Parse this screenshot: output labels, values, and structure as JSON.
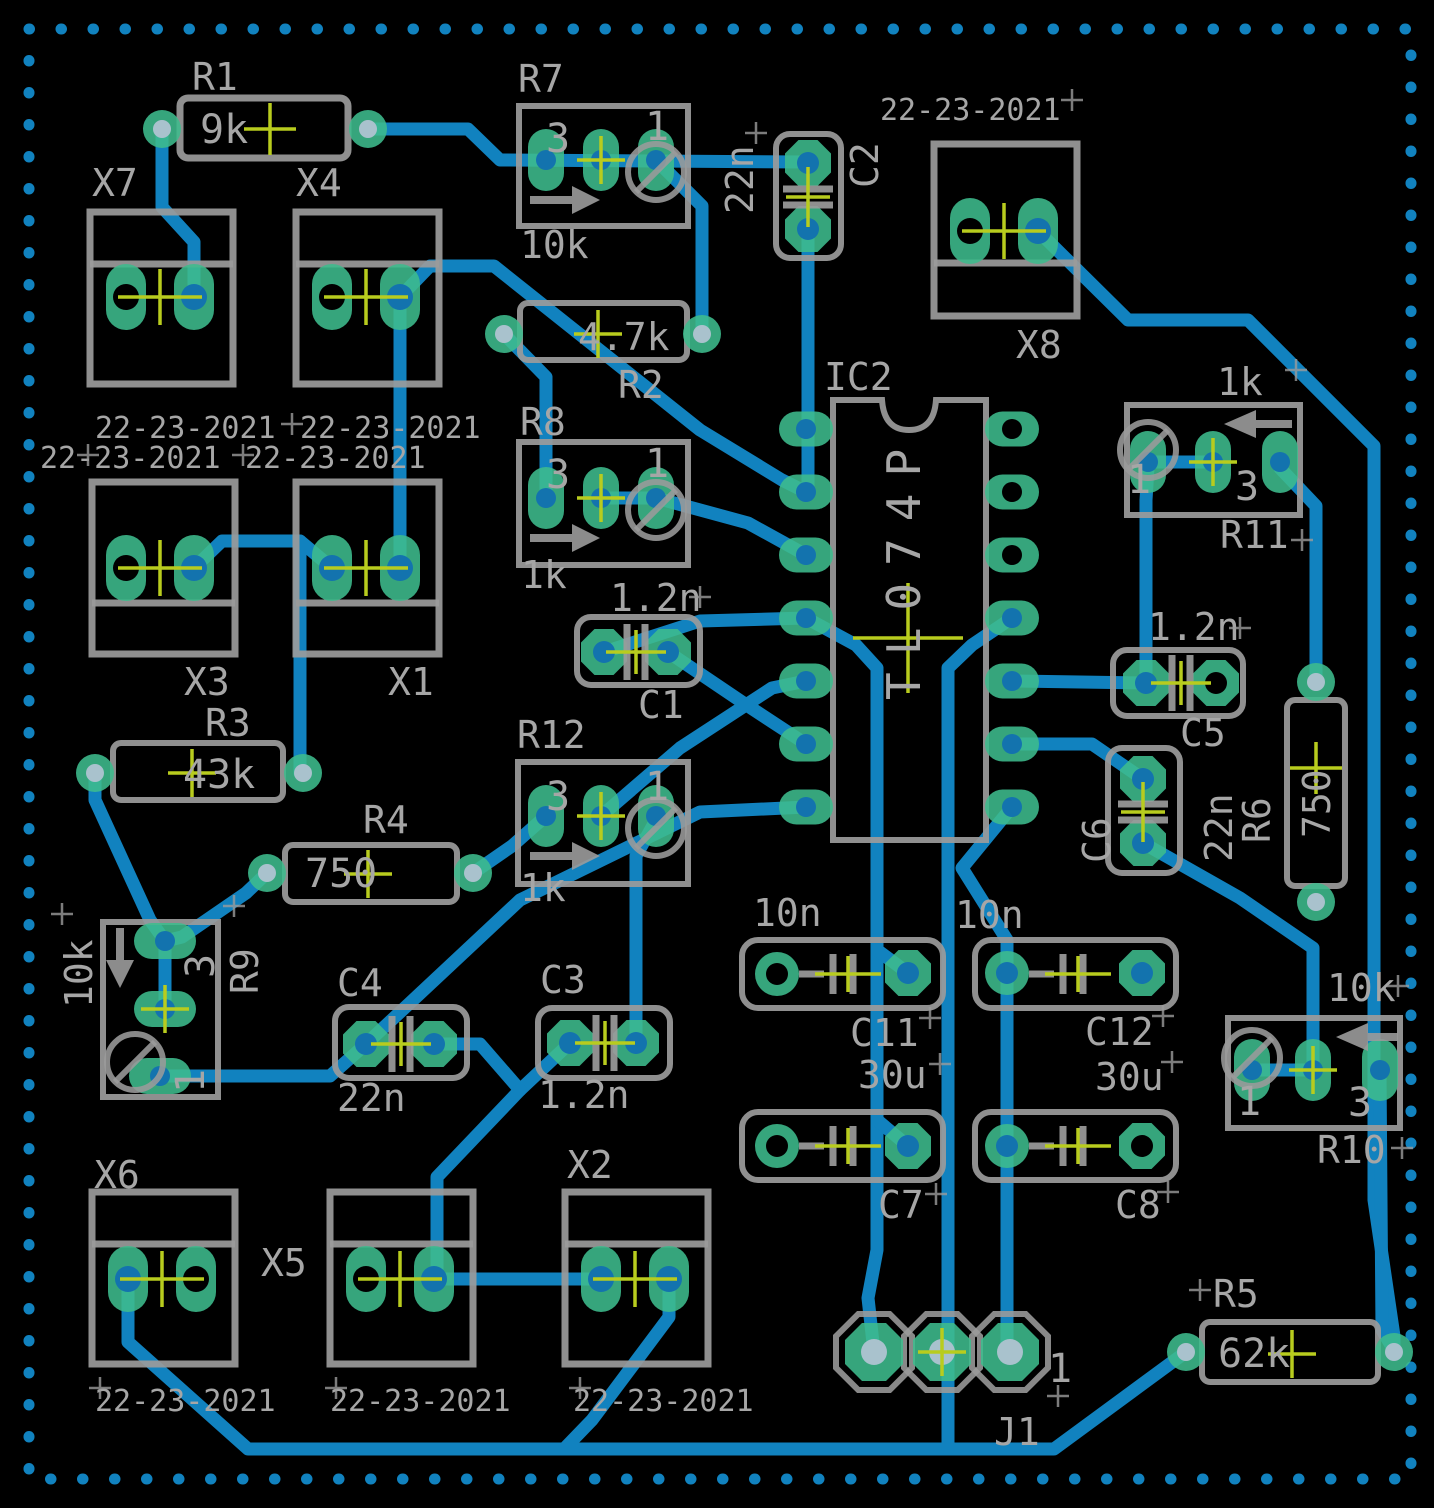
{
  "board": {
    "dates": [
      "22-23-2021",
      "22-23-2021",
      "22-23-2021",
      "22-23-2021",
      "22-23-2021",
      "22-23-2021",
      "22-23-2021",
      "22-23-2021"
    ],
    "parts": {
      "IC2": {
        "ref": "IC2",
        "value": "TL074P"
      },
      "R1": {
        "ref": "R1",
        "value": "9k"
      },
      "R2": {
        "ref": "R2",
        "value": "4.7k"
      },
      "R3": {
        "ref": "R3",
        "value": "43k"
      },
      "R4": {
        "ref": "R4",
        "value": "750"
      },
      "R5": {
        "ref": "R5",
        "value": "62k"
      },
      "R6": {
        "ref": "R6",
        "value": "750"
      },
      "R7": {
        "ref": "R7",
        "value": "10k",
        "pin3": "3",
        "pin1": "1"
      },
      "R8": {
        "ref": "R8",
        "value": "1k",
        "pin3": "3",
        "pin1": "1"
      },
      "R9": {
        "ref": "R9",
        "value": "10k",
        "pin3": "3",
        "pin1": "1"
      },
      "R10": {
        "ref": "R10",
        "value": "10k",
        "pin3": "3",
        "pin1": "1"
      },
      "R11": {
        "ref": "R11",
        "value": "1k",
        "pin3": "3",
        "pin1": "1"
      },
      "R12": {
        "ref": "R12",
        "value": "1k",
        "pin3": "3",
        "pin1": "1"
      },
      "C1": {
        "ref": "C1",
        "value": "1.2n"
      },
      "C2": {
        "ref": "C2",
        "value": "22n"
      },
      "C3": {
        "ref": "C3",
        "value": "1.2n"
      },
      "C4": {
        "ref": "C4",
        "value": "22n"
      },
      "C5": {
        "ref": "C5",
        "value": "1.2n"
      },
      "C6": {
        "ref": "C6",
        "value": "22n"
      },
      "C7": {
        "ref": "C7",
        "value": "30u"
      },
      "C8": {
        "ref": "C8",
        "value": "30u"
      },
      "C11": {
        "ref": "C11",
        "value": "10n"
      },
      "C12": {
        "ref": "C12",
        "value": "10n"
      },
      "X1": {
        "ref": "X1"
      },
      "X2": {
        "ref": "X2"
      },
      "X3": {
        "ref": "X3"
      },
      "X4": {
        "ref": "X4"
      },
      "X5": {
        "ref": "X5"
      },
      "X6": {
        "ref": "X6"
      },
      "X7": {
        "ref": "X7"
      },
      "X8": {
        "ref": "X8"
      },
      "J1": {
        "ref": "J1",
        "pin1": "1"
      }
    },
    "colors": {
      "background": "#000000",
      "trace": "#1182bf",
      "pad": "#3dbc8d",
      "silkscreen": "#9b9b9b",
      "plated_hole": "#a9c2cd",
      "drilled_hole": "#1373ae",
      "origin_cross": "#b8cc1e"
    }
  }
}
